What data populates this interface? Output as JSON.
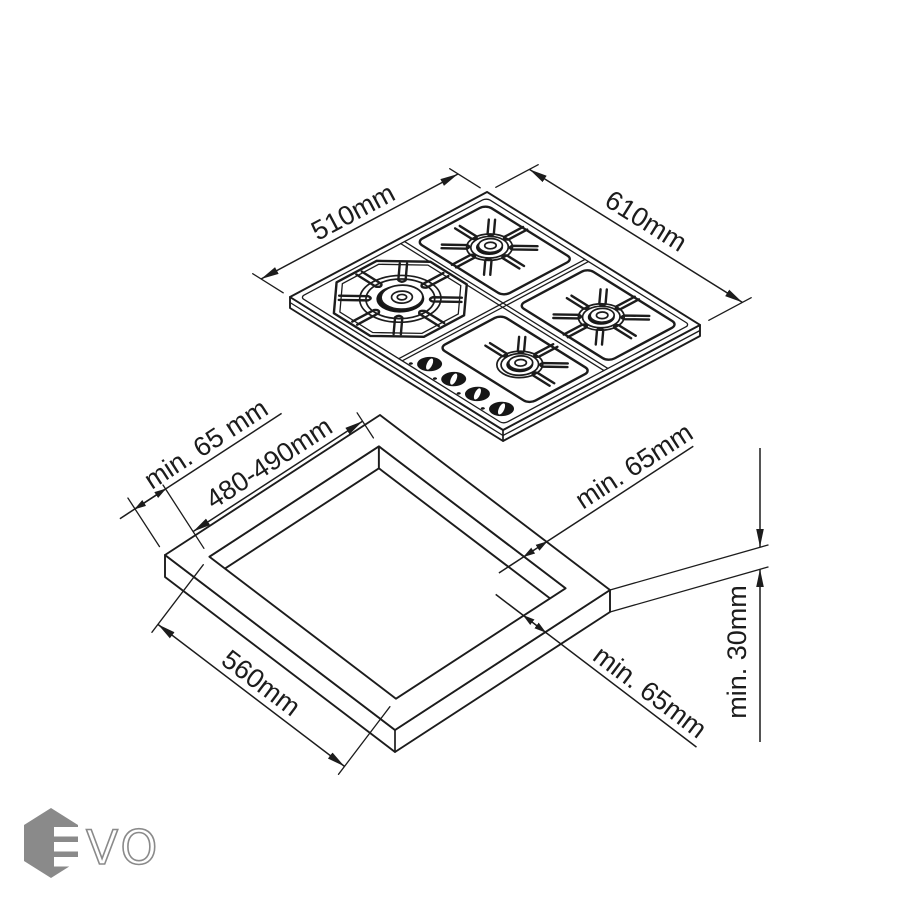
{
  "diagram": {
    "title": "Gas hob built-in installation drawing",
    "hob": {
      "burner_count": 4,
      "knob_count": 4,
      "depth_label": "510mm",
      "width_label": "610mm"
    },
    "cutout": {
      "left_margin_label": "min. 65 mm",
      "depth_label": "480-490mm",
      "right_margin_label": "min. 65mm",
      "width_label": "560mm",
      "bottom_margin_label": "min. 65mm",
      "thickness_label": "min. 30mm"
    }
  },
  "logo": {
    "wordmark": "VO",
    "mark_icon": "hexagon-e"
  },
  "colors": {
    "line": "#1c1c1c",
    "logo_gray": "#8a8a8a",
    "background": "#ffffff"
  }
}
